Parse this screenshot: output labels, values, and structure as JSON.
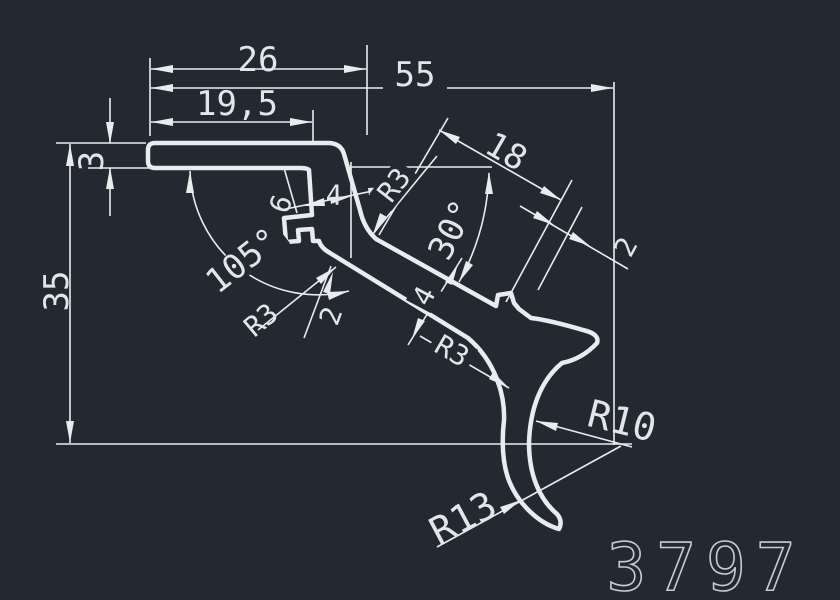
{
  "app": {
    "type": "cad-profile-drawing",
    "part_number": "3797"
  },
  "colors": {
    "background": "#232831",
    "lines": "#e9ecef",
    "text": "#e2e6e9",
    "part_number": "#c6ccd2"
  },
  "dimensions": {
    "top_width": "26",
    "overall_width": "55",
    "flange_width": "19,5",
    "flange_thickness": "3",
    "overall_height": "35",
    "bend_angle": "105°",
    "groove_depth": "6",
    "wall_width": "4",
    "bend_fillet": "R3",
    "leg_length": "18",
    "leg_angle": "30°",
    "prong_thickness": "2",
    "leg_width": "4",
    "leg_fillet": "R3",
    "groove_lip": "2",
    "inner_fillet": "R3",
    "hook_inner_radius": "R10",
    "hook_outer_radius": "R13"
  }
}
